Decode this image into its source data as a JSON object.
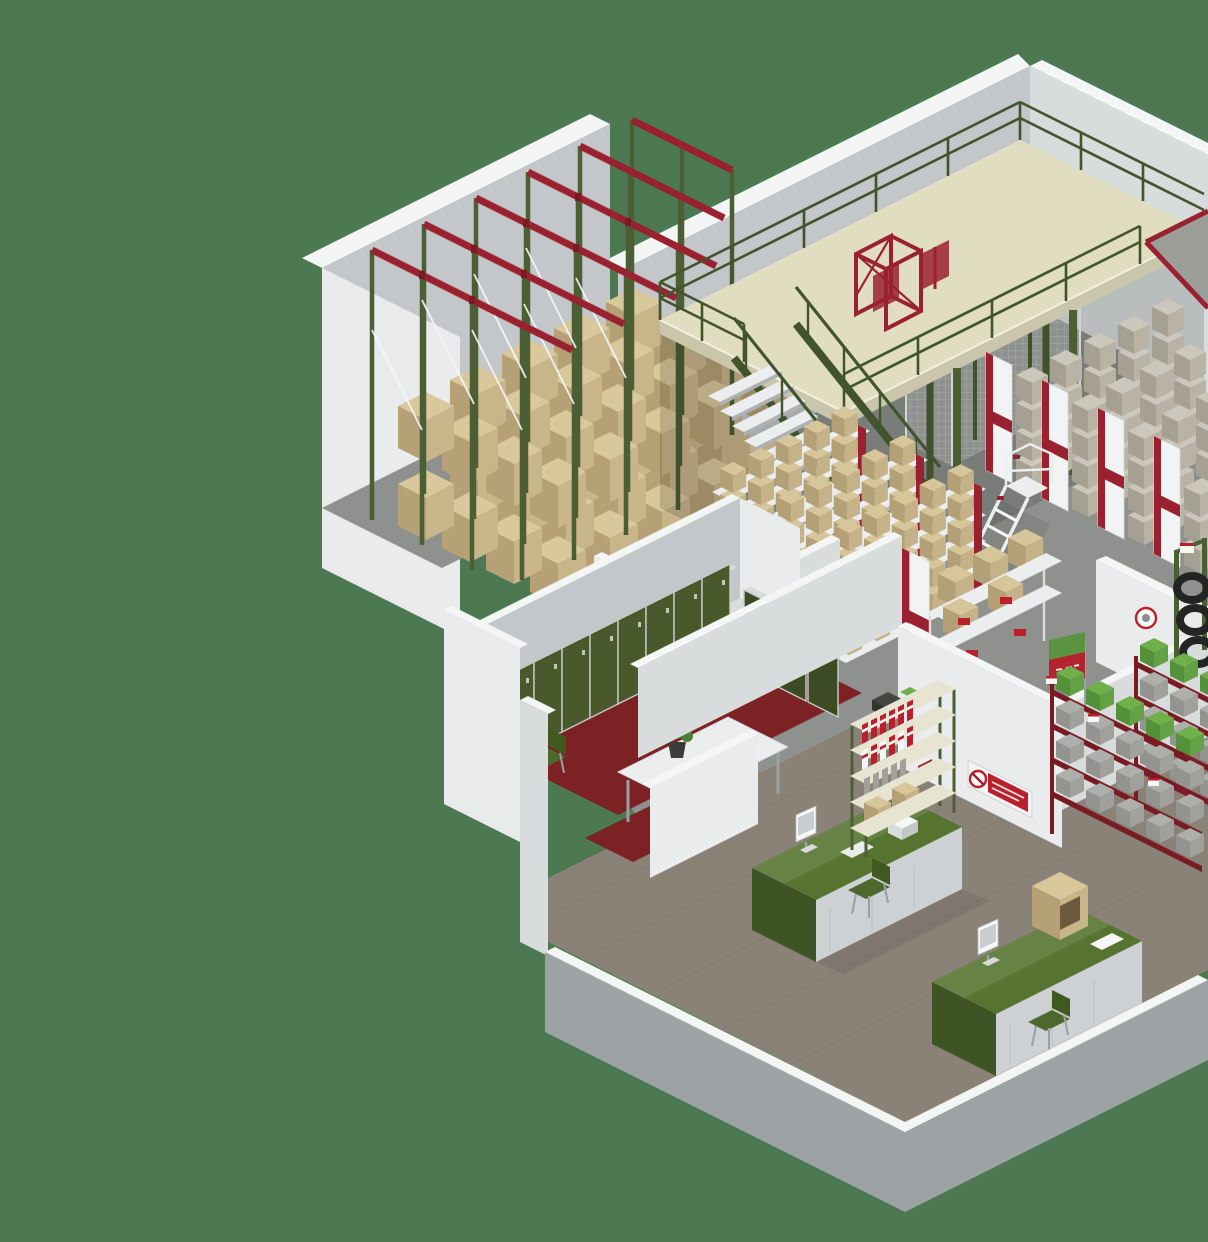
{
  "image": {
    "type": "3d-isometric-render",
    "subject": "warehouse interior cutaway",
    "width": 1208,
    "height": 1242
  },
  "colors": {
    "background": "#4d7952",
    "wallBright": "#e9ebec",
    "wallLight": "#d9dcdd",
    "wallMid": "#c3c7c9",
    "wallShade": "#adb2b5",
    "wallCap": "#f4f5f5",
    "wallOuter": "#9da2a5",
    "floorConcrete": "#8e918d",
    "floorWood": "#8a8177",
    "floorTileRed": "#7c2124",
    "mezzFloor": "#e0ddc1",
    "mezzEdgeSide": "#c9c6ab",
    "railGreen": "#41542e",
    "columnGreen": "#4c5f34",
    "accentRed": "#9a2230",
    "darkRed": "#781b23",
    "signRed": "#bb1f2b",
    "cartonTop": "#dac89d",
    "cartonLeft": "#b6a176",
    "cartonRight": "#c9b58a",
    "sboxTop": "#cbc7ba",
    "sboxLeft": "#a5a091",
    "sboxRight": "#b8b3a4",
    "tanTop": "#d8c69b",
    "tanLeft": "#b4a077",
    "tanRight": "#c6b289",
    "shelfWhite": "#ecedee",
    "panelWhite": "#f2f3f3",
    "lockerGreen": "#49592c",
    "lockerGreenDark": "#3d4b24",
    "frameGray": "#c9cbcd",
    "deskTop": "#567430",
    "deskDark": "#3e5424",
    "deskPanel": "#ced1d3",
    "chairGreen": "#4d682c",
    "chairBack": "#40591f",
    "binGrayTop": "#aeaeaa",
    "binGrayFront": "#939390",
    "binGraySide": "#a0a09c",
    "binGreenTop": "#6fb04b",
    "binGreenFront": "#55903a",
    "binGreenSide": "#63a244",
    "white": "#f6f7f7",
    "black": "#212224",
    "plantGreen": "#4e7d35",
    "potDark": "#3a3c38",
    "screenGray": "#c7cdd0",
    "metalGray": "#9aa0a3",
    "rampGray": "#9b9e99"
  },
  "scene": {
    "areas": [
      {
        "name": "drive-in-pallet-racking",
        "detail": "green uprights, red top beams, white bracing, tan cartons"
      },
      {
        "name": "mezzanine-floor",
        "detail": "cream deck, green safety railing, red pallet gate, red-edged ramp"
      },
      {
        "name": "access-stairs",
        "detail": "white treads, green stringers and handrails"
      },
      {
        "name": "machine-guard-mesh-cage"
      },
      {
        "name": "small-parts-shelving-rows",
        "detail": "white end panels with red stripes, gray and tan boxes"
      },
      {
        "name": "mobile-step-ladder"
      },
      {
        "name": "locker-room",
        "detail": "green lockers, red tile floor, white table with plant, green chairs"
      },
      {
        "name": "office-reception",
        "detail": "two green desks with monitors, green chairs, binder shelving"
      },
      {
        "name": "red-bin-racking",
        "detail": "gray and green bins with small price tags"
      },
      {
        "name": "tyre-rack"
      },
      {
        "name": "no-smoking-wall-sign"
      },
      {
        "name": "round-prohibition-sign"
      },
      {
        "name": "red-green-marker-flags"
      }
    ]
  }
}
